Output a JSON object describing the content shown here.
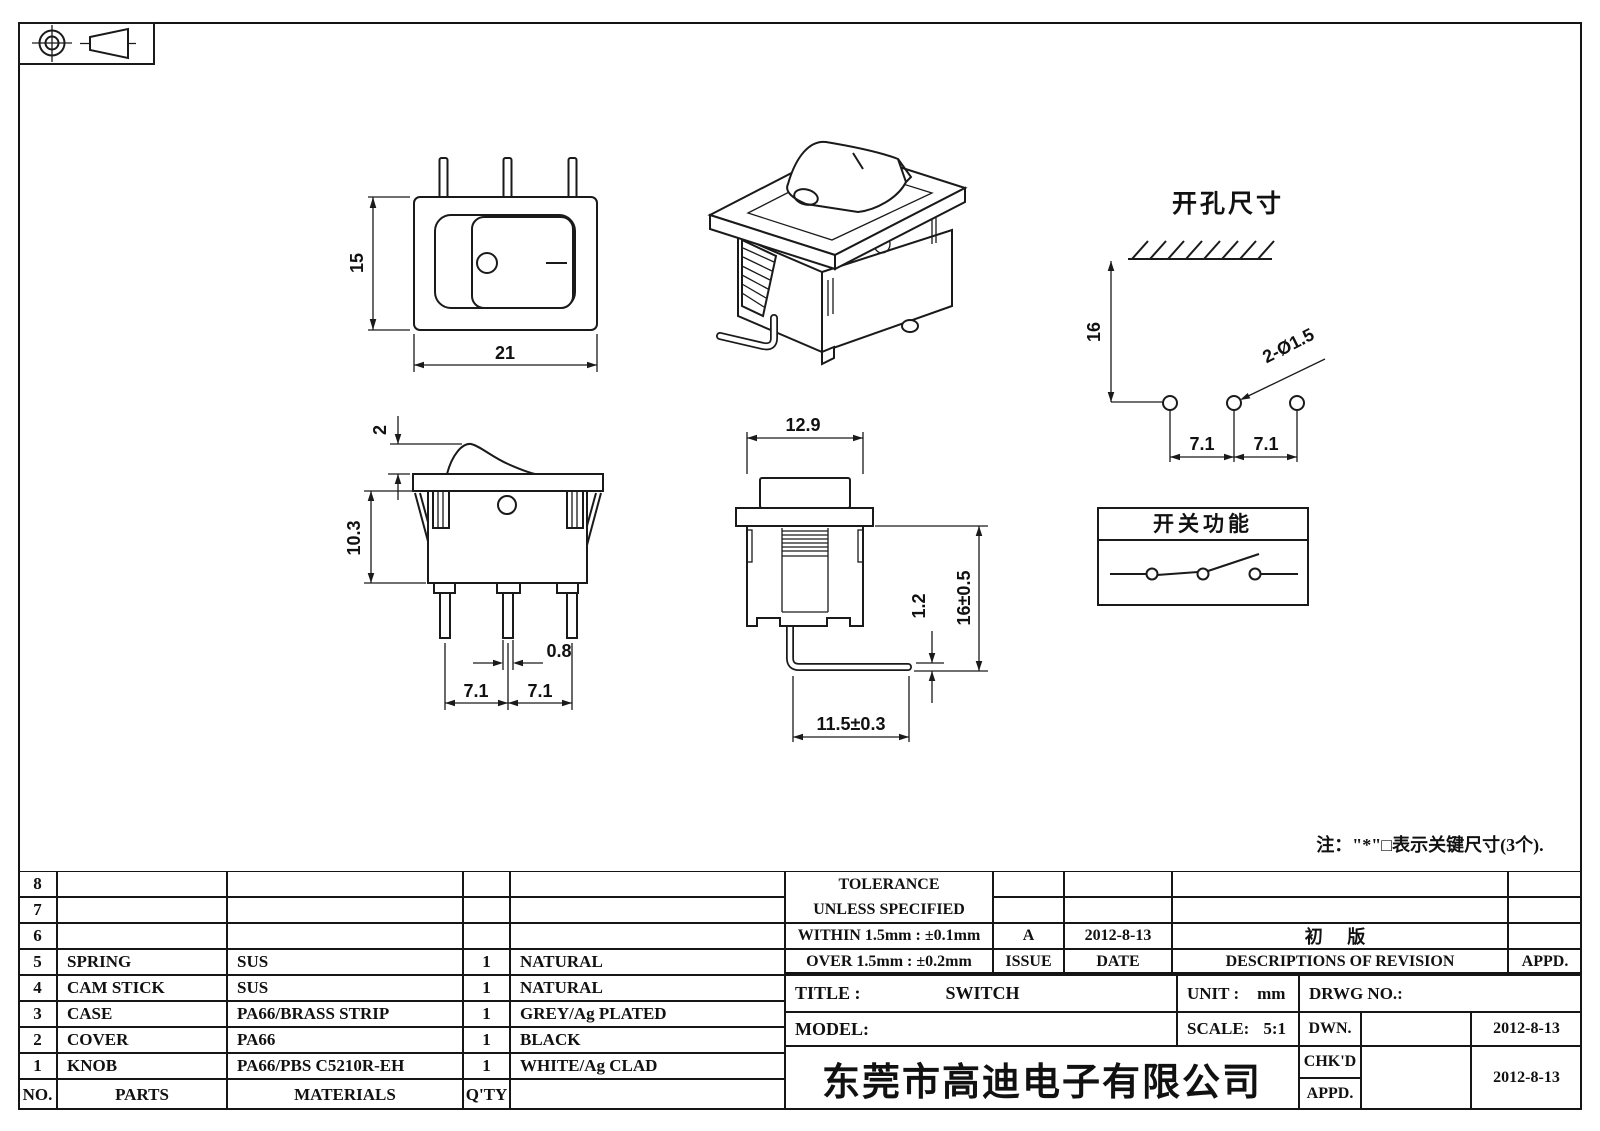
{
  "views": {
    "front": {
      "height": "15",
      "width": "21"
    },
    "side": {
      "knob_height": "2",
      "body_height": "10.3",
      "pin_width": "0.8",
      "pitch1": "7.1",
      "pitch2": "7.1"
    },
    "end": {
      "width": "12.9",
      "pin_thickness": "1.2",
      "total_height": "16±0.5",
      "pin_length": "11.5±0.3"
    },
    "cutout": {
      "title": "开孔尺寸",
      "depth": "16",
      "holes": "2-Ø1.5",
      "pitch1": "7.1",
      "pitch2": "7.1"
    },
    "function": {
      "title": "开关功能"
    },
    "note": "注：\"*\"□表示关键尺寸(3个)."
  },
  "bom": {
    "headers": {
      "no": "NO.",
      "parts": "PARTS",
      "materials": "MATERIALS",
      "qty": "Q'TY",
      "finish": ""
    },
    "rows": [
      {
        "no": "8",
        "parts": "",
        "materials": "",
        "qty": "",
        "finish": ""
      },
      {
        "no": "7",
        "parts": "",
        "materials": "",
        "qty": "",
        "finish": ""
      },
      {
        "no": "6",
        "parts": "",
        "materials": "",
        "qty": "",
        "finish": ""
      },
      {
        "no": "5",
        "parts": "SPRING",
        "materials": "SUS",
        "qty": "1",
        "finish": "NATURAL"
      },
      {
        "no": "4",
        "parts": "CAM STICK",
        "materials": "SUS",
        "qty": "1",
        "finish": "NATURAL"
      },
      {
        "no": "3",
        "parts": "CASE",
        "materials": "PA66/BRASS STRIP",
        "qty": "1",
        "finish": "GREY/Ag PLATED"
      },
      {
        "no": "2",
        "parts": "COVER",
        "materials": "PA66",
        "qty": "1",
        "finish": "BLACK"
      },
      {
        "no": "1",
        "parts": "KNOB",
        "materials": "PA66/PBS C5210R-EH",
        "qty": "1",
        "finish": "WHITE/Ag CLAD"
      }
    ]
  },
  "title_block": {
    "tolerance_line1": "TOLERANCE",
    "tolerance_line2": "UNLESS  SPECIFIED",
    "tolerance_within": "WITHIN 1.5mm : ±0.1mm",
    "tolerance_over": "OVER 1.5mm : ±0.2mm",
    "revision": {
      "issue": "A",
      "date": "2012-8-13",
      "description": "初 版"
    },
    "headers": {
      "issue": "ISSUE",
      "date": "DATE",
      "description": "DESCRIPTIONS OF REVISION",
      "approved": "APPD."
    },
    "title_label": "TITLE :",
    "title_value": "SWITCH",
    "model_label": "MODEL:",
    "unit_label": "UNIT :",
    "unit_value": "mm",
    "scale_label": "SCALE:",
    "scale_value": "5:1",
    "drwg_label": "DRWG NO.:",
    "dwn_label": "DWN.",
    "dwn_date": "2012-8-13",
    "chkd_label": "CHK'D",
    "chkd_date": "2012-8-13",
    "appd_label": "APPD.",
    "company": "东莞市高迪电子有限公司"
  }
}
